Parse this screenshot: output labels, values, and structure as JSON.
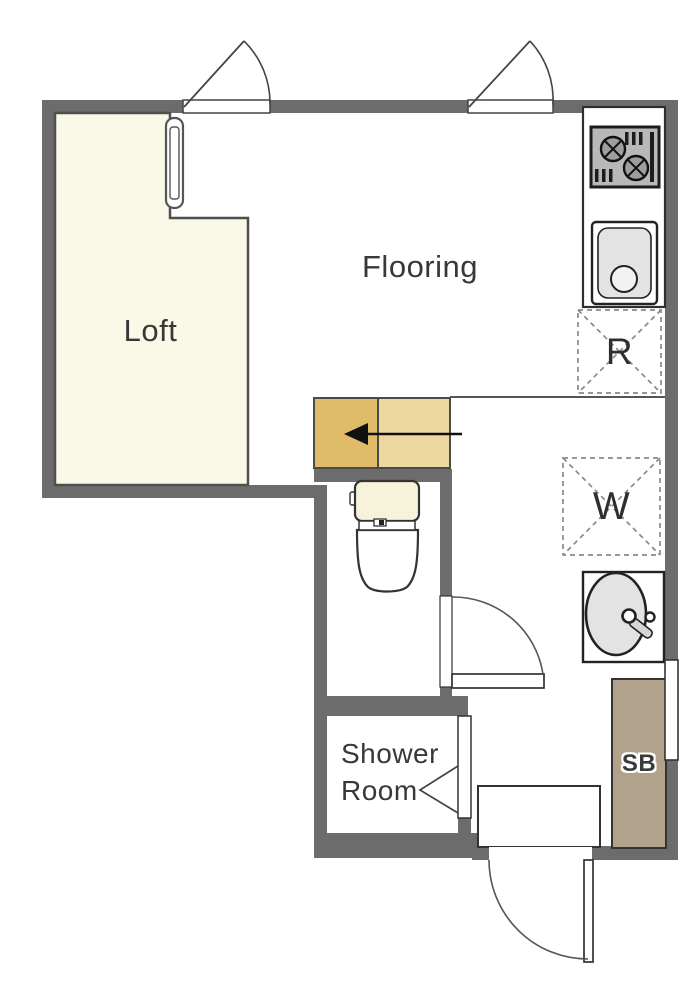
{
  "plan": {
    "rooms": {
      "flooring": {
        "label": "Flooring"
      },
      "loft": {
        "label": "Loft"
      },
      "shower_room": {
        "label_line1": "Shower",
        "label_line2": "Room"
      }
    },
    "spaces": {
      "refrigerator": {
        "label": "R"
      },
      "washer": {
        "label": "W"
      },
      "shoe_box": {
        "label": "SB"
      }
    },
    "fixtures": [
      "gas-stove",
      "kitchen-sink",
      "refrigerator-space",
      "washer-space",
      "washbasin",
      "toilet",
      "loft-steps",
      "loft-ladder",
      "casement-window",
      "casement-window",
      "side-window",
      "toilet-door",
      "shower-folding-door",
      "entrance-door",
      "genkan-step"
    ],
    "annotations": {
      "steps_arrow_direction": "left"
    }
  },
  "colors": {
    "wall": "#6c6c6c",
    "loft-fill": "#faf8e6",
    "step-dark": "#e0bc6a",
    "step-light": "#ecd89e",
    "shoebox-fill": "#b2a28c",
    "fixture-gray": "#e3e3e3",
    "toilet-tank": "#f6f3da",
    "line": "#333333",
    "label": "#383838"
  }
}
